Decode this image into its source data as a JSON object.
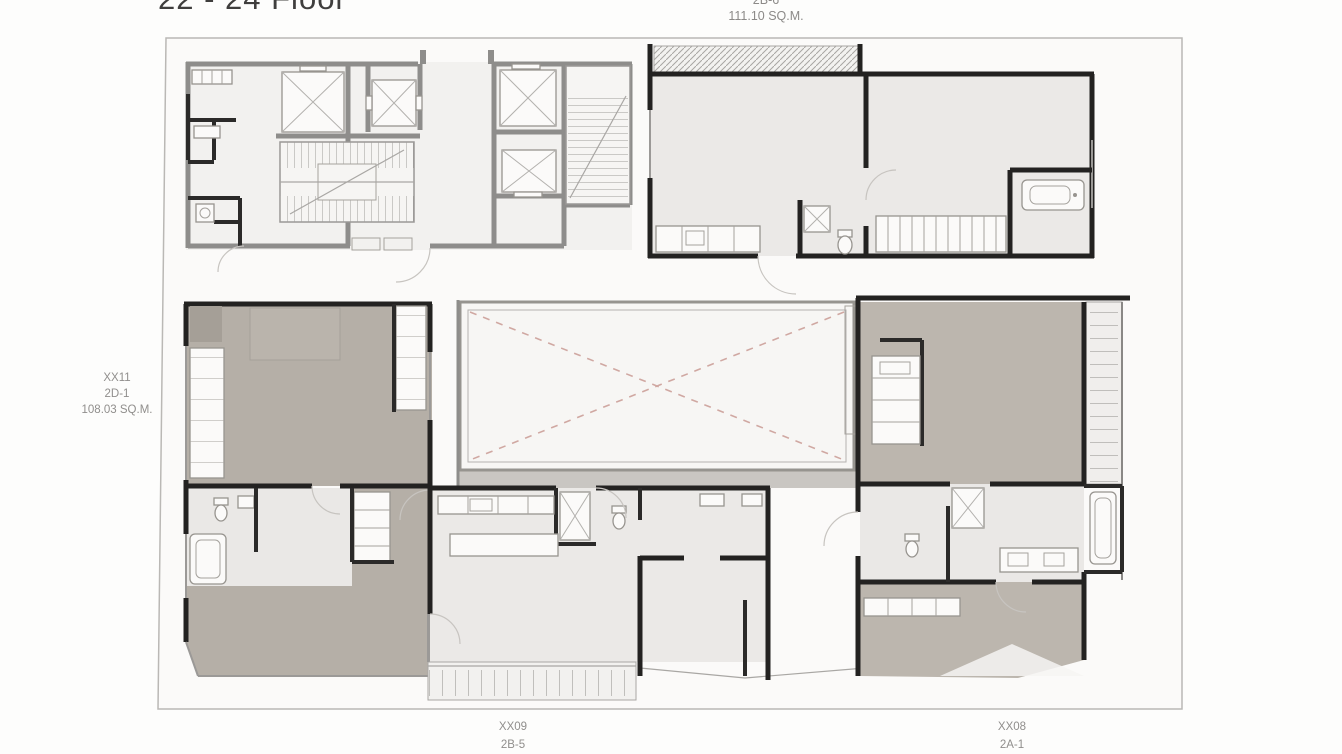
{
  "page": {
    "title": "22 - 24 Floor"
  },
  "plan": {
    "units": {
      "top": {
        "type": "2B-6",
        "area": "111.10 SQ.M."
      },
      "left": {
        "id": "XX11",
        "type": "2D-1",
        "area": "108.03 SQ.M."
      },
      "bottom_center": {
        "id": "XX09",
        "type": "2B-5"
      },
      "bottom_right": {
        "id": "XX08",
        "type": "2A-1"
      }
    },
    "colors": {
      "wall_black": "#232221",
      "wall_gray": "#8e8d8b",
      "floor_light": "#ebe9e7",
      "floor_taupe": "#b6b0a8",
      "void_dash_pink": "#d0a8a2",
      "sheet_outline": "#bab8b5",
      "label_text": "#908e8c",
      "title_text": "#3f3e3d"
    }
  }
}
